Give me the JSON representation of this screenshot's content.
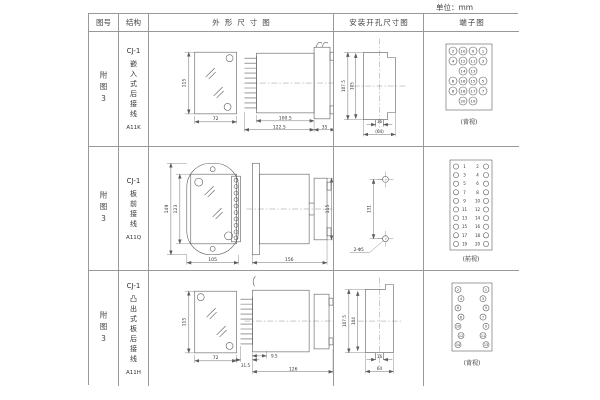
{
  "unit_label": "单位：mm",
  "table": {
    "headers": {
      "figure": "图号",
      "structure": "结构",
      "outline": "外形尺寸图",
      "install": "安装开孔尺寸图",
      "terminal": "端子图"
    },
    "rows": [
      {
        "figure": "附图3",
        "structure": {
          "model": "CJ-1",
          "mount": "嵌入式后接线",
          "code": "A11K"
        },
        "outline": {
          "height": "115",
          "width": "72",
          "depth": "100.5",
          "depth_total": "122.5",
          "flange": "35"
        },
        "install": {
          "outer": "107.5",
          "inner": "105",
          "slot": "16",
          "span": "(64)"
        },
        "terminal": {
          "view": "(背视)",
          "numbers": [
            [
              2,
              10,
              9,
              1
            ],
            [
              4,
              12,
              11,
              3
            ],
            [
              null,
              14,
              13,
              null
            ],
            [
              6,
              16,
              15,
              5
            ],
            [
              8,
              18,
              17,
              7
            ],
            [
              null,
              20,
              19,
              null
            ]
          ]
        }
      },
      {
        "figure": "附图3",
        "structure": {
          "model": "CJ-1",
          "mount": "板前接线",
          "code": "A11Q"
        },
        "outline": {
          "plate_height": "149",
          "body_height": "123",
          "plate_width": "105",
          "depth": "156",
          "height": "115"
        },
        "install": {
          "pitch": "131",
          "holes": "2-Φ5"
        },
        "terminal": {
          "view": "(前视)",
          "left": [
            1,
            3,
            5,
            7,
            9,
            11,
            13,
            15,
            17,
            19
          ],
          "right": [
            2,
            4,
            6,
            8,
            10,
            12,
            14,
            16,
            18,
            20
          ]
        }
      },
      {
        "figure": "附图3",
        "structure": {
          "model": "CJ-1",
          "mount": "凸出式板后接线",
          "code": "A11H"
        },
        "outline": {
          "height": "115",
          "width": "72",
          "terminal_depth": "31.5",
          "offset": "9.5",
          "depth": "126"
        },
        "install": {
          "outer": "107.5",
          "inner": "104",
          "slot": "16",
          "span": "64"
        },
        "terminal": {
          "view": "(背视)",
          "left": [
            2,
            4,
            6,
            8,
            10,
            12,
            14
          ],
          "right": [
            1,
            3,
            5,
            7,
            9,
            11,
            13
          ]
        }
      }
    ]
  }
}
